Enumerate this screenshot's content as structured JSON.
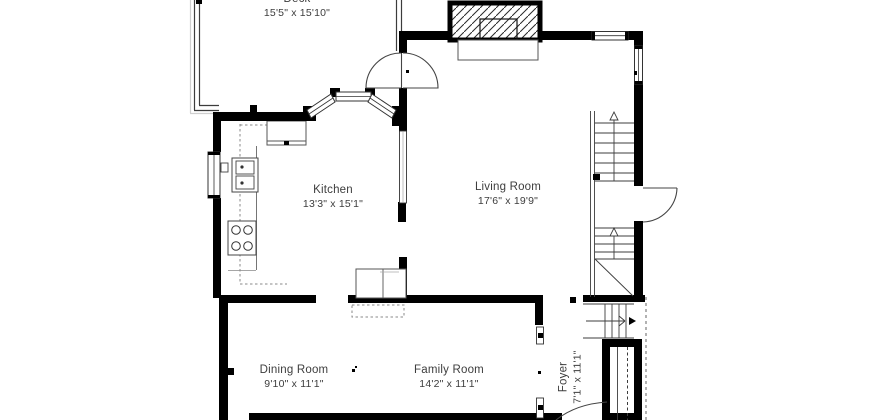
{
  "plan": {
    "type": "floorplan",
    "rooms": {
      "deck": {
        "name": "Deck",
        "dims": "15'5\" x 15'10\""
      },
      "kitchen": {
        "name": "Kitchen",
        "dims": "13'3\" x 15'1\""
      },
      "living": {
        "name": "Living Room",
        "dims": "17'6\" x 19'9\""
      },
      "dining": {
        "name": "Dining Room",
        "dims": "9'10\" x 11'1\""
      },
      "family": {
        "name": "Family Room",
        "dims": "14'2\" x 11'1\""
      },
      "foyer": {
        "name": "Foyer",
        "dims": "7'1\" x 11'1\""
      }
    },
    "colors": {
      "wall": "#000000",
      "line": "#3c3c3c",
      "text": "#3d3d3d",
      "background": "#ffffff"
    }
  }
}
